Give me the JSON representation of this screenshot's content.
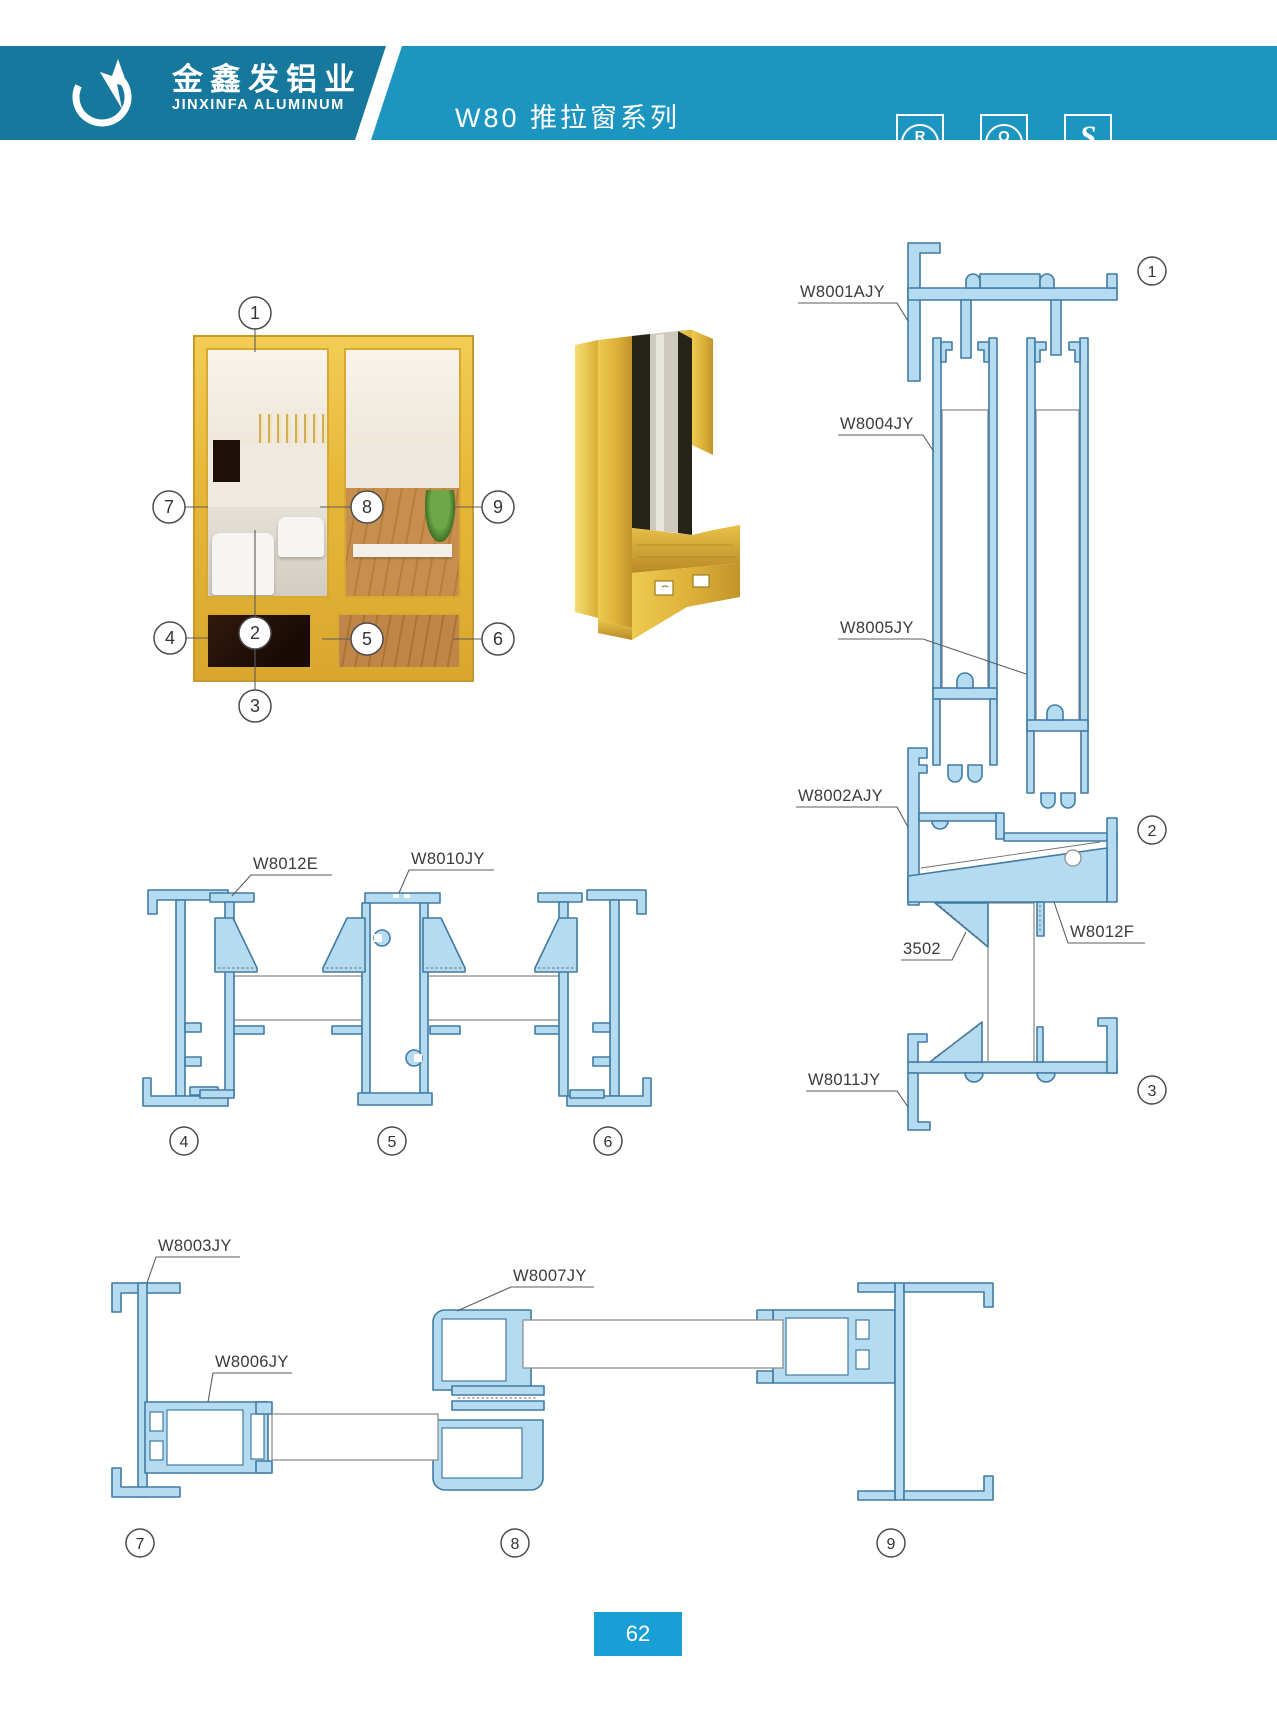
{
  "header": {
    "brand_cn": "金鑫发铝业",
    "brand_en": "JINXINFA ALUMINUM",
    "series_title": "W80 推拉窗系列",
    "badges": [
      {
        "symbol": "R",
        "caption": "CQM"
      },
      {
        "symbol": "Q",
        "caption": "CQM"
      },
      {
        "symbol": "S",
        "caption": "生产许可"
      }
    ]
  },
  "callouts": [
    "1",
    "2",
    "3",
    "4",
    "5",
    "6",
    "7",
    "8",
    "9"
  ],
  "labels": {
    "w8001": "W8001AJY",
    "w8004": "W8004JY",
    "w8005": "W8005JY",
    "w8002": "W8002AJY",
    "n3502": "3502",
    "w8012f": "W8012F",
    "w8011": "W8011JY",
    "w8012e": "W8012E",
    "w8010": "W8010JY",
    "w8003": "W8003JY",
    "w8006": "W8006JY",
    "w8007": "W8007JY"
  },
  "footer": {
    "page_number": "62"
  }
}
